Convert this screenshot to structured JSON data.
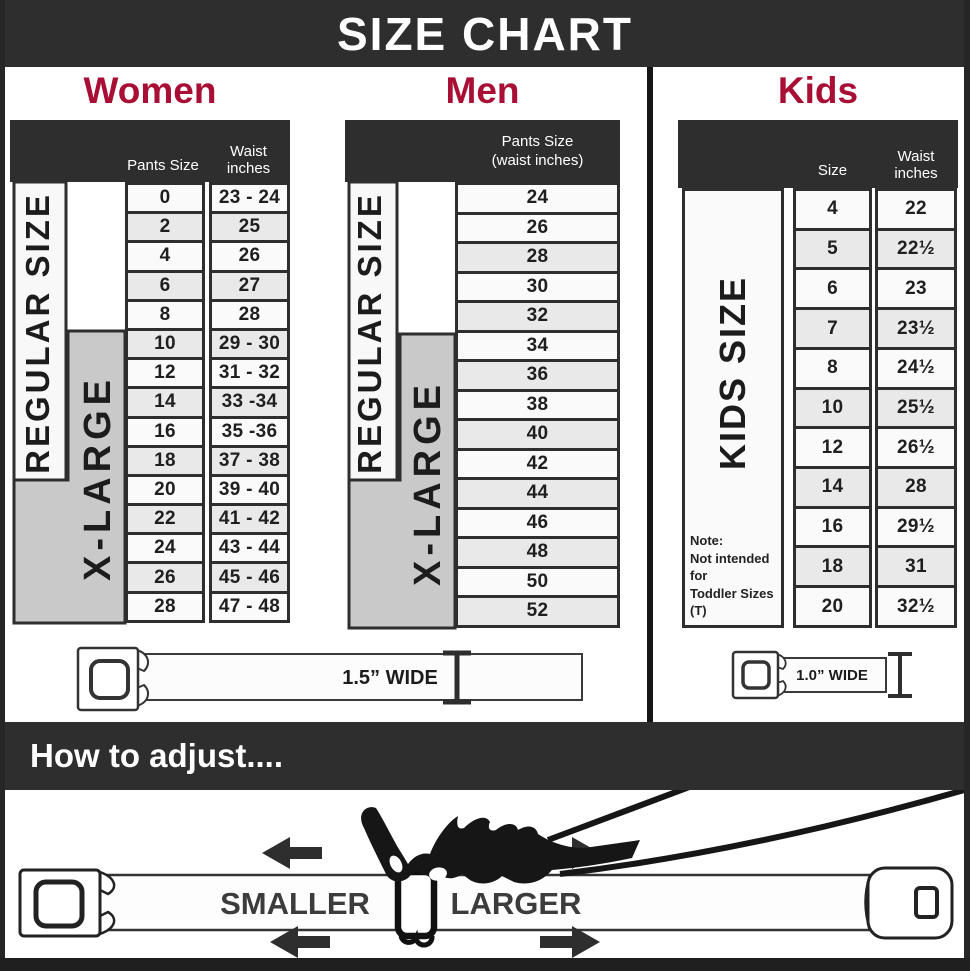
{
  "banner": {
    "title": "SIZE CHART"
  },
  "colors": {
    "dark_bg": "#2e2e2e",
    "accent_red": "#a90e35",
    "row_shaded": "#e9e9e9",
    "xlarge_gray": "#c9c9c9"
  },
  "women": {
    "title": "Women",
    "header": {
      "pants": "Pants Size",
      "waist": "Waist inches"
    },
    "regular_label": "REGULAR SIZE",
    "xlarge_label": "X-LARGE",
    "rows": [
      {
        "pants": "0",
        "waist": "23 - 24"
      },
      {
        "pants": "2",
        "waist": "25"
      },
      {
        "pants": "4",
        "waist": "26"
      },
      {
        "pants": "6",
        "waist": "27"
      },
      {
        "pants": "8",
        "waist": "28"
      },
      {
        "pants": "10",
        "waist": "29 - 30"
      },
      {
        "pants": "12",
        "waist": "31 - 32"
      },
      {
        "pants": "14",
        "waist": "33 -34"
      },
      {
        "pants": "16",
        "waist": "35 -36"
      },
      {
        "pants": "18",
        "waist": "37 - 38"
      },
      {
        "pants": "20",
        "waist": "39 - 40"
      },
      {
        "pants": "22",
        "waist": "41 - 42"
      },
      {
        "pants": "24",
        "waist": "43 - 44"
      },
      {
        "pants": "26",
        "waist": "45 - 46"
      },
      {
        "pants": "28",
        "waist": "47 - 48"
      }
    ],
    "belt_width_label": "1.5” WIDE"
  },
  "men": {
    "title": "Men",
    "header_line1": "Pants Size",
    "header_line2": "(waist inches)",
    "regular_label": "REGULAR SIZE",
    "xlarge_label": "X-LARGE",
    "rows": [
      "24",
      "26",
      "28",
      "30",
      "32",
      "34",
      "36",
      "38",
      "40",
      "42",
      "44",
      "46",
      "48",
      "50",
      "52"
    ]
  },
  "kids": {
    "title": "Kids",
    "header": {
      "size": "Size",
      "waist": "Waist inches"
    },
    "label": "KIDS SIZE",
    "note": {
      "line1": "Note:",
      "line2": "Not intended for",
      "line3": "Toddler Sizes (T)"
    },
    "rows": [
      {
        "size": "4",
        "waist": "22"
      },
      {
        "size": "5",
        "waist": "22½"
      },
      {
        "size": "6",
        "waist": "23"
      },
      {
        "size": "7",
        "waist": "23½"
      },
      {
        "size": "8",
        "waist": "24½"
      },
      {
        "size": "10",
        "waist": "25½"
      },
      {
        "size": "12",
        "waist": "26½"
      },
      {
        "size": "14",
        "waist": "28"
      },
      {
        "size": "16",
        "waist": "29½"
      },
      {
        "size": "18",
        "waist": "31"
      },
      {
        "size": "20",
        "waist": "32½"
      }
    ],
    "belt_width_label": "1.0” WIDE"
  },
  "adjust": {
    "title": "How to adjust....",
    "smaller_label": "SMALLER",
    "larger_label": "LARGER"
  }
}
